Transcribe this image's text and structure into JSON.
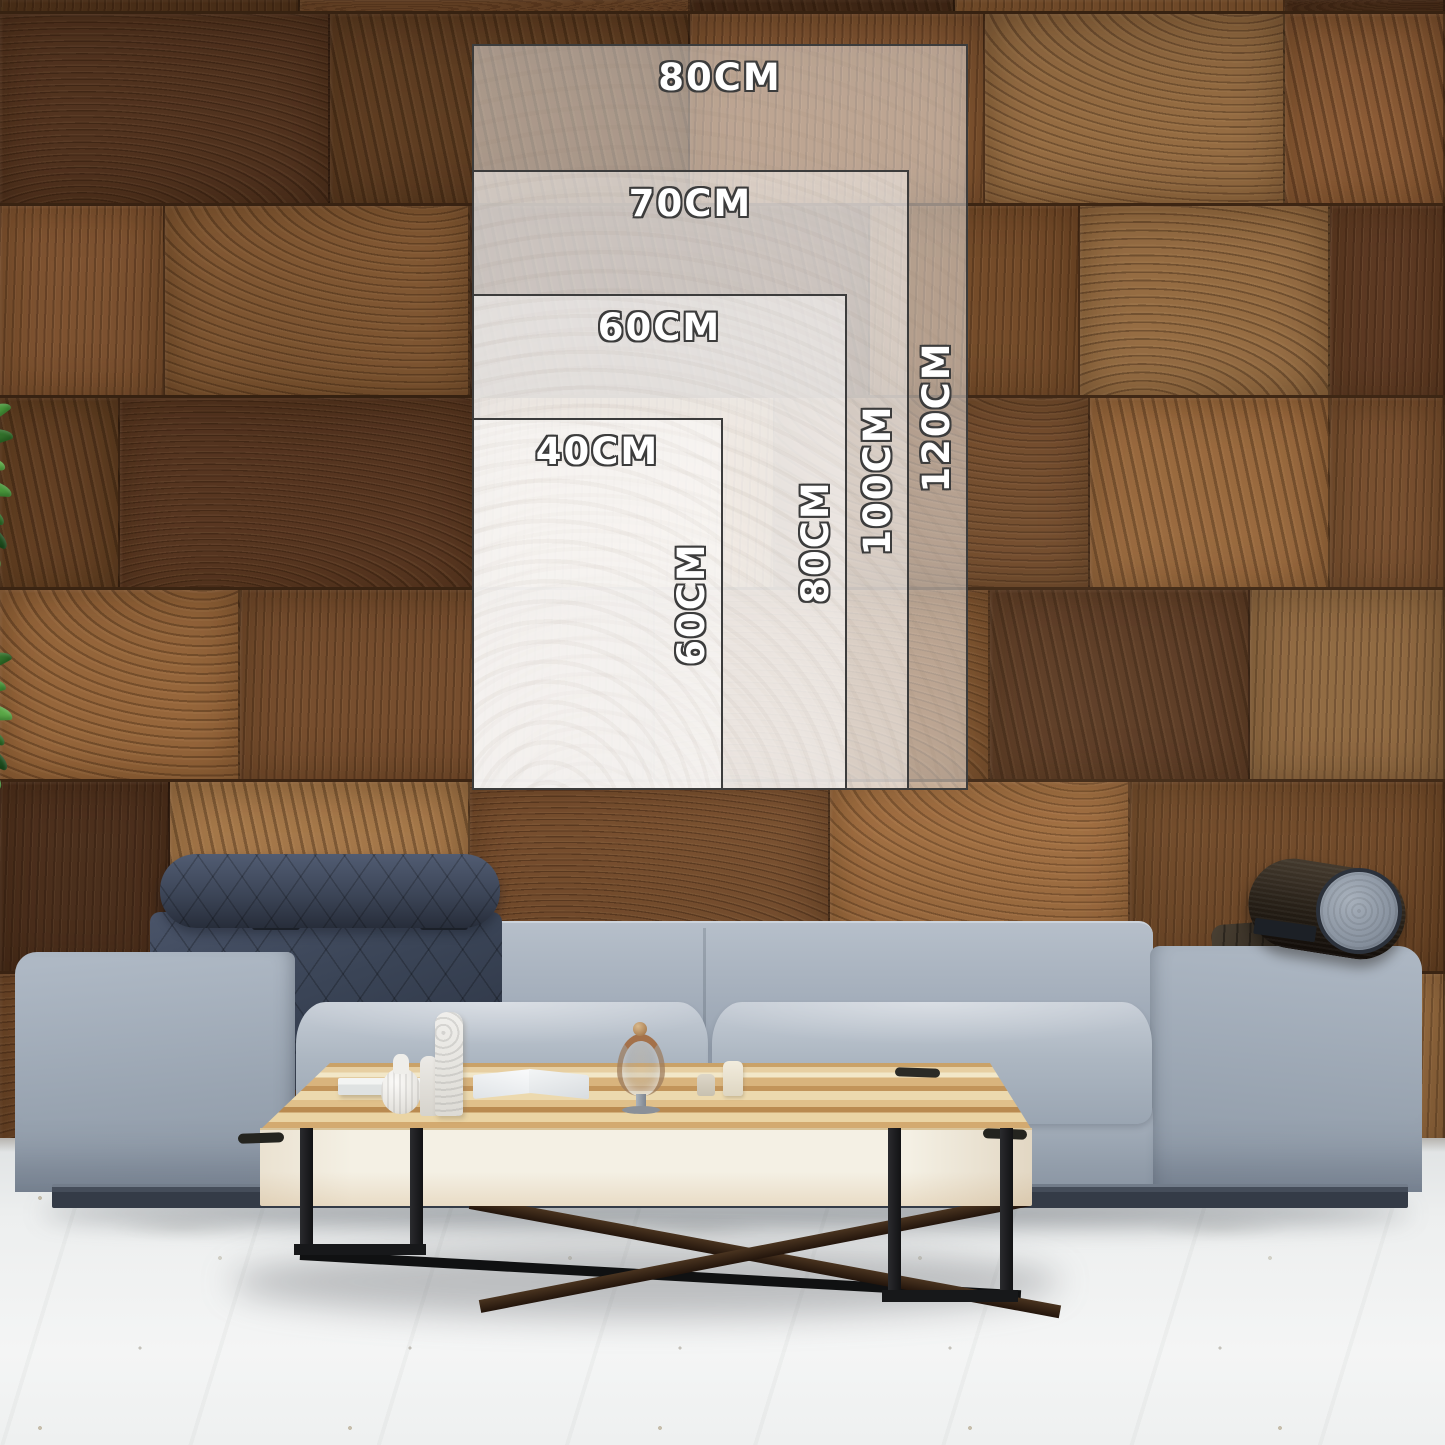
{
  "size_guide": {
    "sizes": [
      {
        "name": "80x120",
        "width_label": "80CM",
        "height_label": "120CM"
      },
      {
        "name": "70x100",
        "width_label": "70CM",
        "height_label": "100CM"
      },
      {
        "name": "60x80",
        "width_label": "60CM",
        "height_label": "80CM"
      },
      {
        "name": "40x60",
        "width_label": "40CM",
        "height_label": "60CM"
      }
    ]
  },
  "palette": {
    "wall_dark": "#553520",
    "wall_mid": "#6e4727",
    "wall_brown": "#7d5230",
    "wall_light": "#8f6138",
    "wall_tan": "#9d7246",
    "sofa_mid": "#a0abb8",
    "sofa_base": "#3a414d",
    "headrest": "#3e4859",
    "bolster": "#2c251c",
    "table_wood": "#dcb985",
    "table_face": "#f2eddd",
    "leg": "#18191b",
    "floor": "#eef0f1",
    "plant": "#3f8f35",
    "overlay_fill": "rgba(255,255,255,0.47)",
    "overlay_border": "#3c3c3c",
    "label_color": "#ffffff",
    "label_outline": "#3c3c3c"
  }
}
